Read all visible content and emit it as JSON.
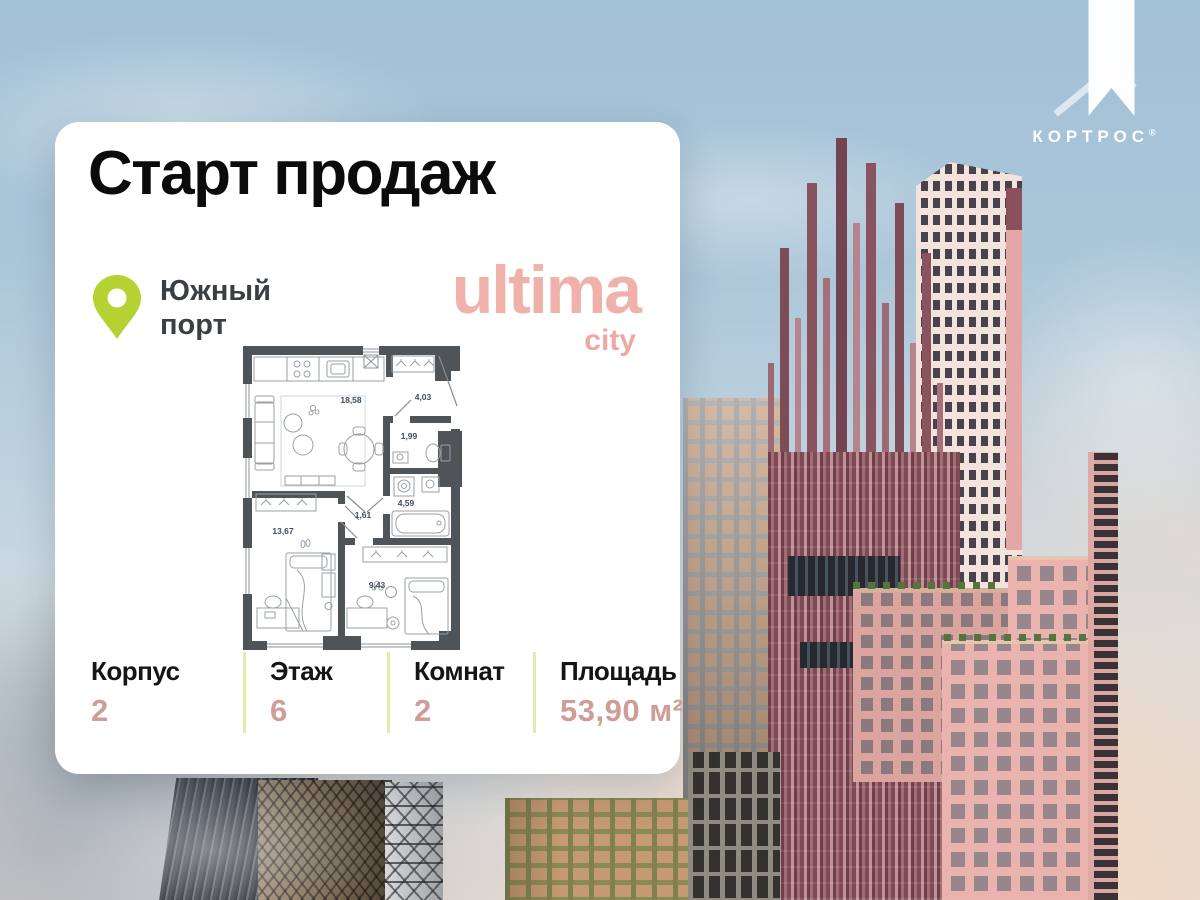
{
  "brand_logo": {
    "name": "КОРТРОС",
    "reg": "®"
  },
  "card": {
    "title": "Старт продаж",
    "location": {
      "line1": "Южный",
      "line2": "порт"
    },
    "project": {
      "name": "ultima",
      "sub": "city"
    },
    "floorplan": {
      "areas": {
        "living": "18,58",
        "hallway": "4,03",
        "wc": "1,99",
        "bathroom": "4,59",
        "corridor": "1,61",
        "bedroom1": "13,67",
        "bedroom2": "9,43"
      }
    },
    "stats": [
      {
        "label": "Корпус",
        "value": "2"
      },
      {
        "label": "Этаж",
        "value": "6"
      },
      {
        "label": "Комнат",
        "value": "2"
      },
      {
        "label": "Площадь",
        "value": "53,90 м²"
      }
    ]
  },
  "icons": {
    "location_pin": "map-pin",
    "kortros_house": "house-band"
  },
  "colors": {
    "pin_green": "#b5d233",
    "brand_pink": "#f0b1ab",
    "stat_value_pink": "#cf9d97",
    "divider_lime": "#e4e9b4",
    "plan_wall": "#4f5459",
    "plan_label": "#3e4d66"
  }
}
